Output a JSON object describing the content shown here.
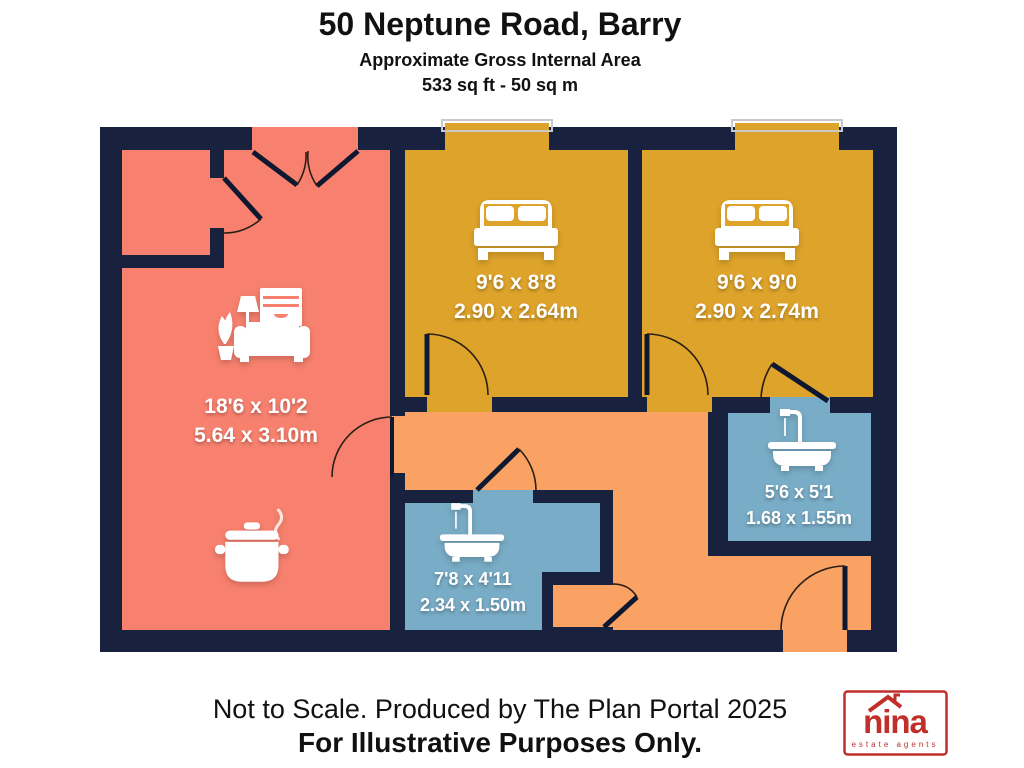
{
  "header": {
    "title": "50 Neptune Road, Barry",
    "subtitle": "Approximate Gross Internal Area",
    "area": "533 sq ft - 50 sq m"
  },
  "rooms": [
    {
      "id": "living-room-kitchen",
      "label_ft": "18'6 x 10'2",
      "label_m": "5.64 x 3.10m",
      "color": "#F8806E",
      "icons": [
        "sofa-icon",
        "cooking-pot-icon"
      ]
    },
    {
      "id": "bedroom-1",
      "label_ft": "9'6 x 8'8",
      "label_m": "2.90 x 2.64m",
      "color": "#DDA32B",
      "icons": [
        "double-bed-icon"
      ]
    },
    {
      "id": "bedroom-2",
      "label_ft": "9'6 x 9'0",
      "label_m": "2.90 x 2.74m",
      "color": "#DDA32B",
      "icons": [
        "double-bed-icon"
      ]
    },
    {
      "id": "bathroom-lower",
      "label_ft": "7'8 x 4'11",
      "label_m": "2.34 x 1.50m",
      "color": "#79ACC6",
      "icons": [
        "bathtub-icon"
      ]
    },
    {
      "id": "bathroom-ensuite",
      "label_ft": "5'6 x 5'1",
      "label_m": "1.68 x 1.55m",
      "color": "#79ACC6",
      "icons": [
        "bathtub-icon"
      ]
    }
  ],
  "footer": {
    "note": "Not to Scale. Produced by The Plan Portal 2025",
    "disclaimer": "For Illustrative Purposes Only."
  },
  "logo": {
    "name": "nina",
    "tagline": "estate agents",
    "color": "#C12F2A"
  },
  "colors": {
    "wall": "#18223E",
    "salmon": "#F8806E",
    "gold": "#DDA32B",
    "orange": "#F9A263",
    "blue": "#79ACC6",
    "frame": "#C8C8C8",
    "arc": "#2B1F14",
    "hall": "#F9A263"
  }
}
